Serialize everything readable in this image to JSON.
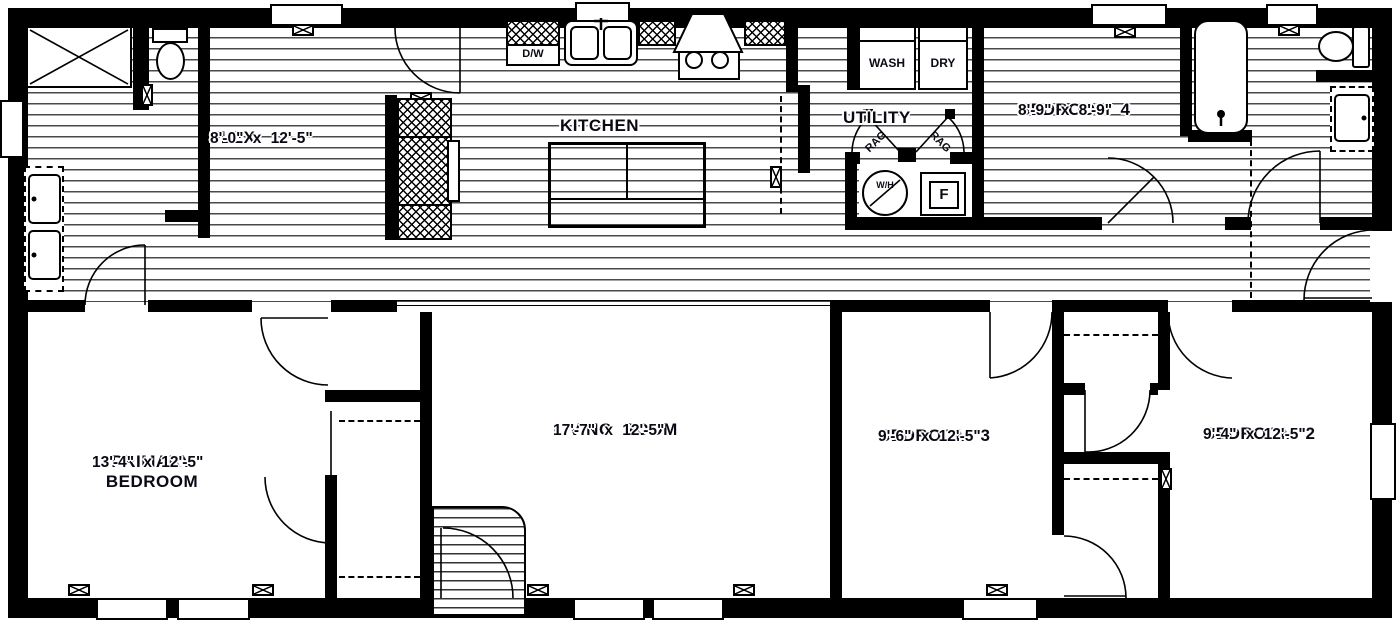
{
  "rooms": {
    "flex": {
      "name": "FLEX",
      "dims": "8'-0\" x 12'-5\""
    },
    "kitchen": {
      "name": "KITCHEN",
      "dims": ""
    },
    "utility": {
      "name": "UTILITY",
      "dims": ""
    },
    "bedroom4": {
      "name": "BEDROOM 4",
      "dims": "8'-9\" x 8'-9\""
    },
    "primary": {
      "name": "PRIMARY BEDROOM",
      "dims": "13'-4\" x 12'-5\""
    },
    "living": {
      "name": "LIVING ROOM",
      "dims": "17'-7\" x 12'-5\""
    },
    "bedroom3": {
      "name": "BEDROOM 3",
      "dims": "9'-6\" x 12'-5\""
    },
    "bedroom2": {
      "name": "BEDROOM 2",
      "dims": "9'-4\" x 12'-5\""
    }
  },
  "labels": {
    "dishwasher": "D/W",
    "washer": "WASH",
    "dryer": "DRY",
    "water_heater": "W/H",
    "furnace": "F",
    "rag": "RAG"
  },
  "colors": {
    "wall": "#000000",
    "text": "#0a0a14",
    "floor_line": "#4a4a4a"
  }
}
